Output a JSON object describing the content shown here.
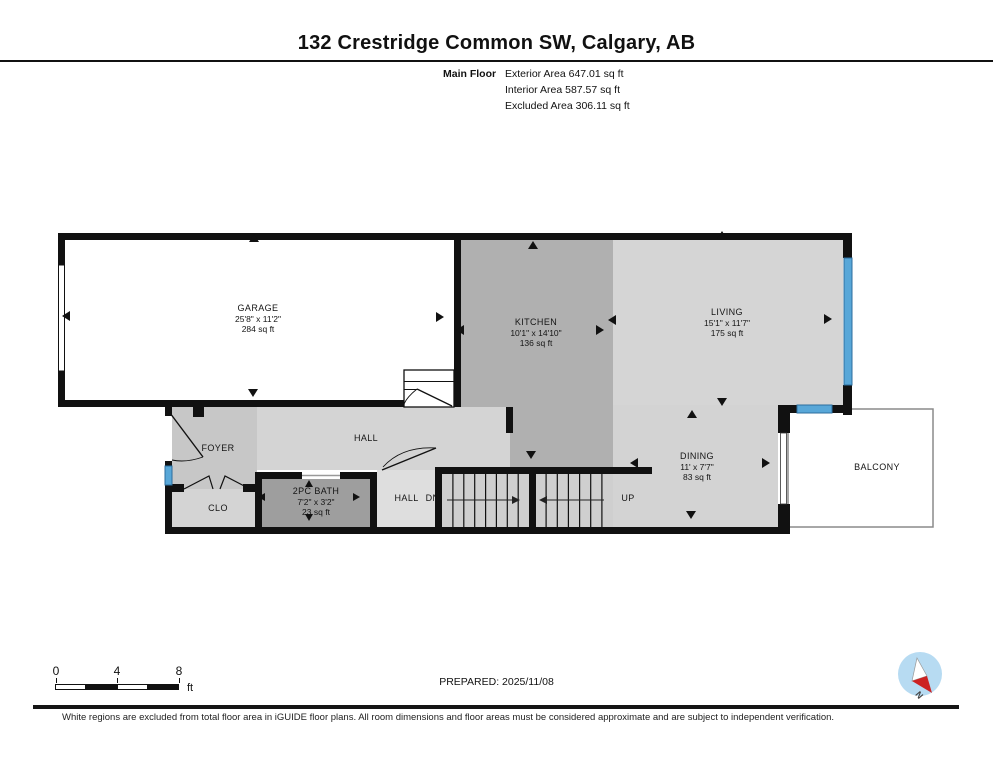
{
  "header": {
    "title": "132 Crestridge Common SW, Calgary, AB",
    "floor_label": "Main Floor",
    "area_lines": [
      "Exterior Area 647.01 sq ft",
      "Interior Area 587.57 sq ft",
      "Excluded Area 306.11 sq ft"
    ]
  },
  "rooms": {
    "garage": {
      "name": "GARAGE",
      "dims": "25'8\" x 11'2\"",
      "area": "284 sq ft"
    },
    "kitchen": {
      "name": "KITCHEN",
      "dims": "10'1\" x 14'10\"",
      "area": "136 sq ft"
    },
    "living": {
      "name": "LIVING",
      "dims": "15'1\" x 11'7\"",
      "area": "175 sq ft"
    },
    "dining": {
      "name": "DINING",
      "dims": "11' x 7'7\"",
      "area": "83 sq ft"
    },
    "bath": {
      "name": "2PC BATH",
      "dims": "7'2\" x 3'2\"",
      "area": "23 sq ft"
    },
    "foyer": {
      "name": "FOYER"
    },
    "hall": {
      "name": "HALL"
    },
    "closet": {
      "name": "CLO"
    },
    "hall_dn": {
      "name": "HALL",
      "direction": "DN"
    },
    "stairs_up": {
      "direction": "UP"
    },
    "balcony": {
      "name": "BALCONY"
    }
  },
  "scale_bar": {
    "labels": [
      "0",
      "4",
      "8"
    ],
    "unit": "ft"
  },
  "footer": {
    "prepared": "PREPARED: 2025/11/08",
    "compass": "N",
    "disclaimer": "White regions are excluded from total floor area in iGUIDE floor plans. All room dimensions and floor areas must be considered approximate and are subject to independent verification."
  },
  "colors": {
    "wall": "#111111",
    "window_marker": "#58a7d8",
    "room_light": "#d4d4d4",
    "room_medium": "#b0b0b0",
    "room_dark": "#9e9e9e",
    "compass_red": "#cc2222",
    "compass_blue": "#b7dbf2"
  }
}
